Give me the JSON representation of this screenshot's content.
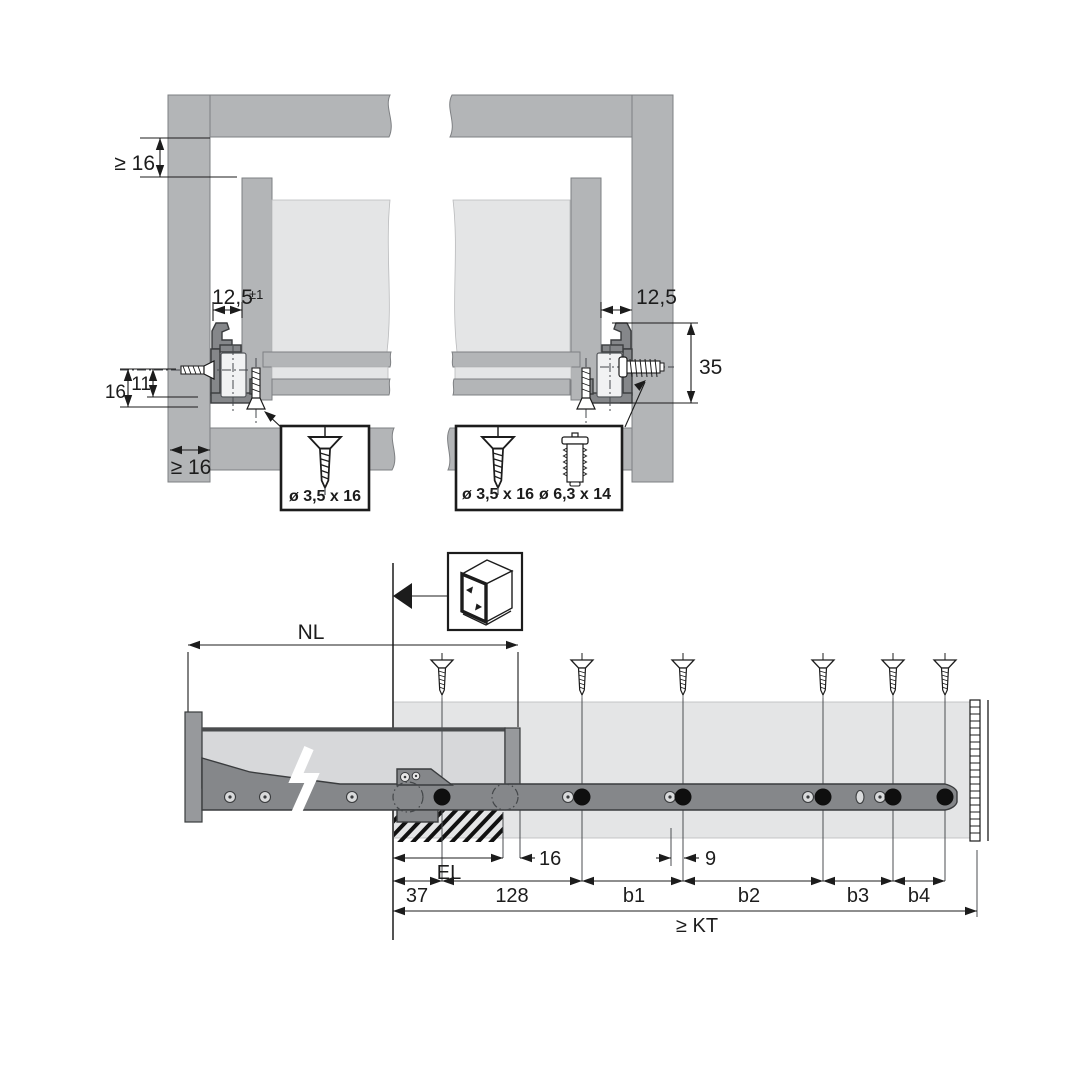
{
  "drawing": {
    "top_left_view": {
      "dim_top_min_thickness": "≥ 16",
      "dim_side_gap": "12,5",
      "dim_side_gap_tolerance": "±1",
      "dim_height_16": "16",
      "dim_height_11": "11",
      "dim_bottom_min_thickness": "≥ 16",
      "screw_spec": "ø 3,5 x 16"
    },
    "top_right_view": {
      "dim_side_gap": "12,5",
      "dim_mount_height": "35",
      "screw_spec_1": "ø 3,5 x 16",
      "screw_spec_2": "ø 6,3 x 14"
    },
    "bottom_view": {
      "dim_nominal_length": "NL",
      "dim_insert_length": "EL",
      "dim_front_offset": "16",
      "dim_hole_offset": "9",
      "dim_first_hole": "37",
      "dim_second_hole": "128",
      "dim_b1": "b1",
      "dim_b2": "b2",
      "dim_b3": "b3",
      "dim_b4": "b4",
      "dim_cabinet_depth": "≥ KT"
    },
    "colors": {
      "panel_gray": "#b3b5b7",
      "light_gray": "#e4e5e6",
      "rail_gray": "#85878a",
      "line_black": "#1c1c1c",
      "background": "#ffffff"
    }
  }
}
